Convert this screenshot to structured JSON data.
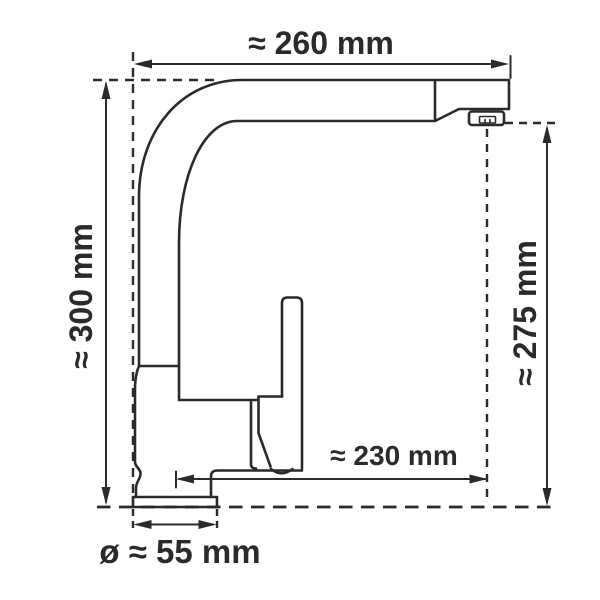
{
  "diagram": {
    "colors": {
      "line": "#2b2a29",
      "background": "#ffffff"
    },
    "dimensions": {
      "spout_width": "≈ 260 mm",
      "total_height": "≈ 300 mm",
      "outlet_height": "≈ 275 mm",
      "spout_reach": "≈ 230 mm",
      "base_diameter": "ø ≈ 55 mm"
    }
  }
}
